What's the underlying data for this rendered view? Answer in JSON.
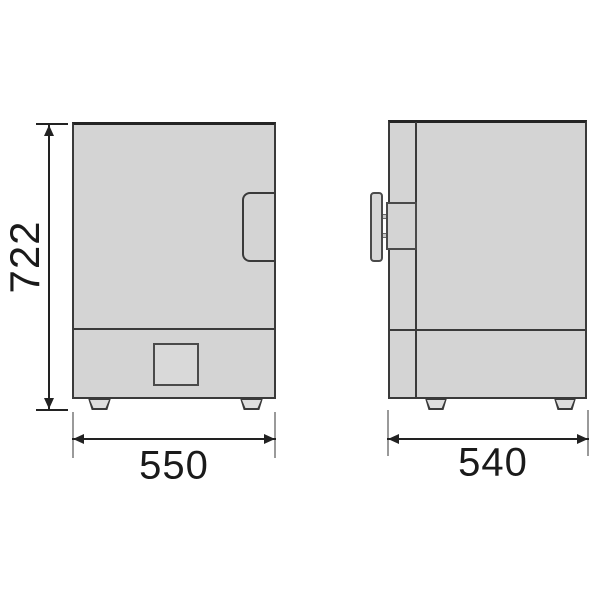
{
  "drawing": {
    "dimensions": {
      "height_label": "722",
      "front_width_label": "550",
      "side_depth_label": "540"
    },
    "colors": {
      "background": "#ffffff",
      "body_fill": "#d4d4d4",
      "outline": "#3a3a3a",
      "extension_line": "#9a9a9a",
      "dimension_line": "#222222",
      "dimension_text": "#1a1a1a"
    }
  }
}
